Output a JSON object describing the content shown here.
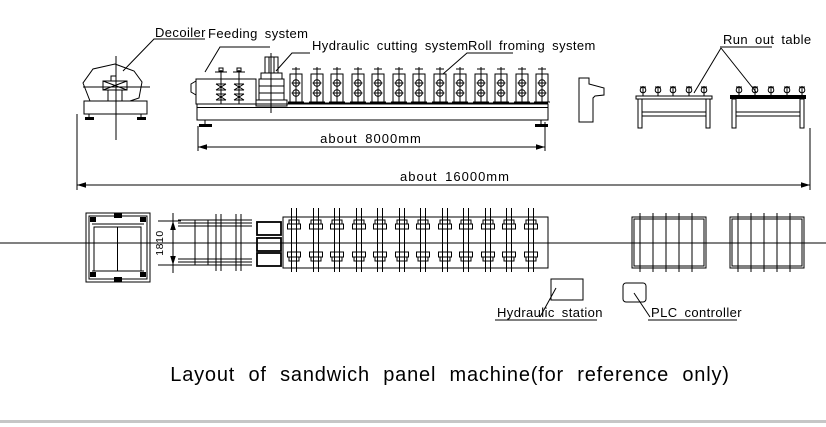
{
  "drawing": {
    "labels": {
      "decoiler": "Decoiler",
      "feeding_system": "Feeding system",
      "hydraulic_cutting_system": "Hydraulic cutting system",
      "roll_forming_system": "Roll froming system",
      "run_out_table": "Run out table",
      "hydraulic_station": "Hydraulic station",
      "plc_controller": "PLC controller"
    },
    "dimensions": {
      "forming_line_length": "about 8000mm",
      "total_length": "about 16000mm",
      "machine_width": "1810"
    },
    "caption": "Layout of sandwich panel machine(for reference only)",
    "colors": {
      "line": "#000000",
      "background": "#ffffff",
      "bottom_divider": "#c6c6c6"
    }
  }
}
